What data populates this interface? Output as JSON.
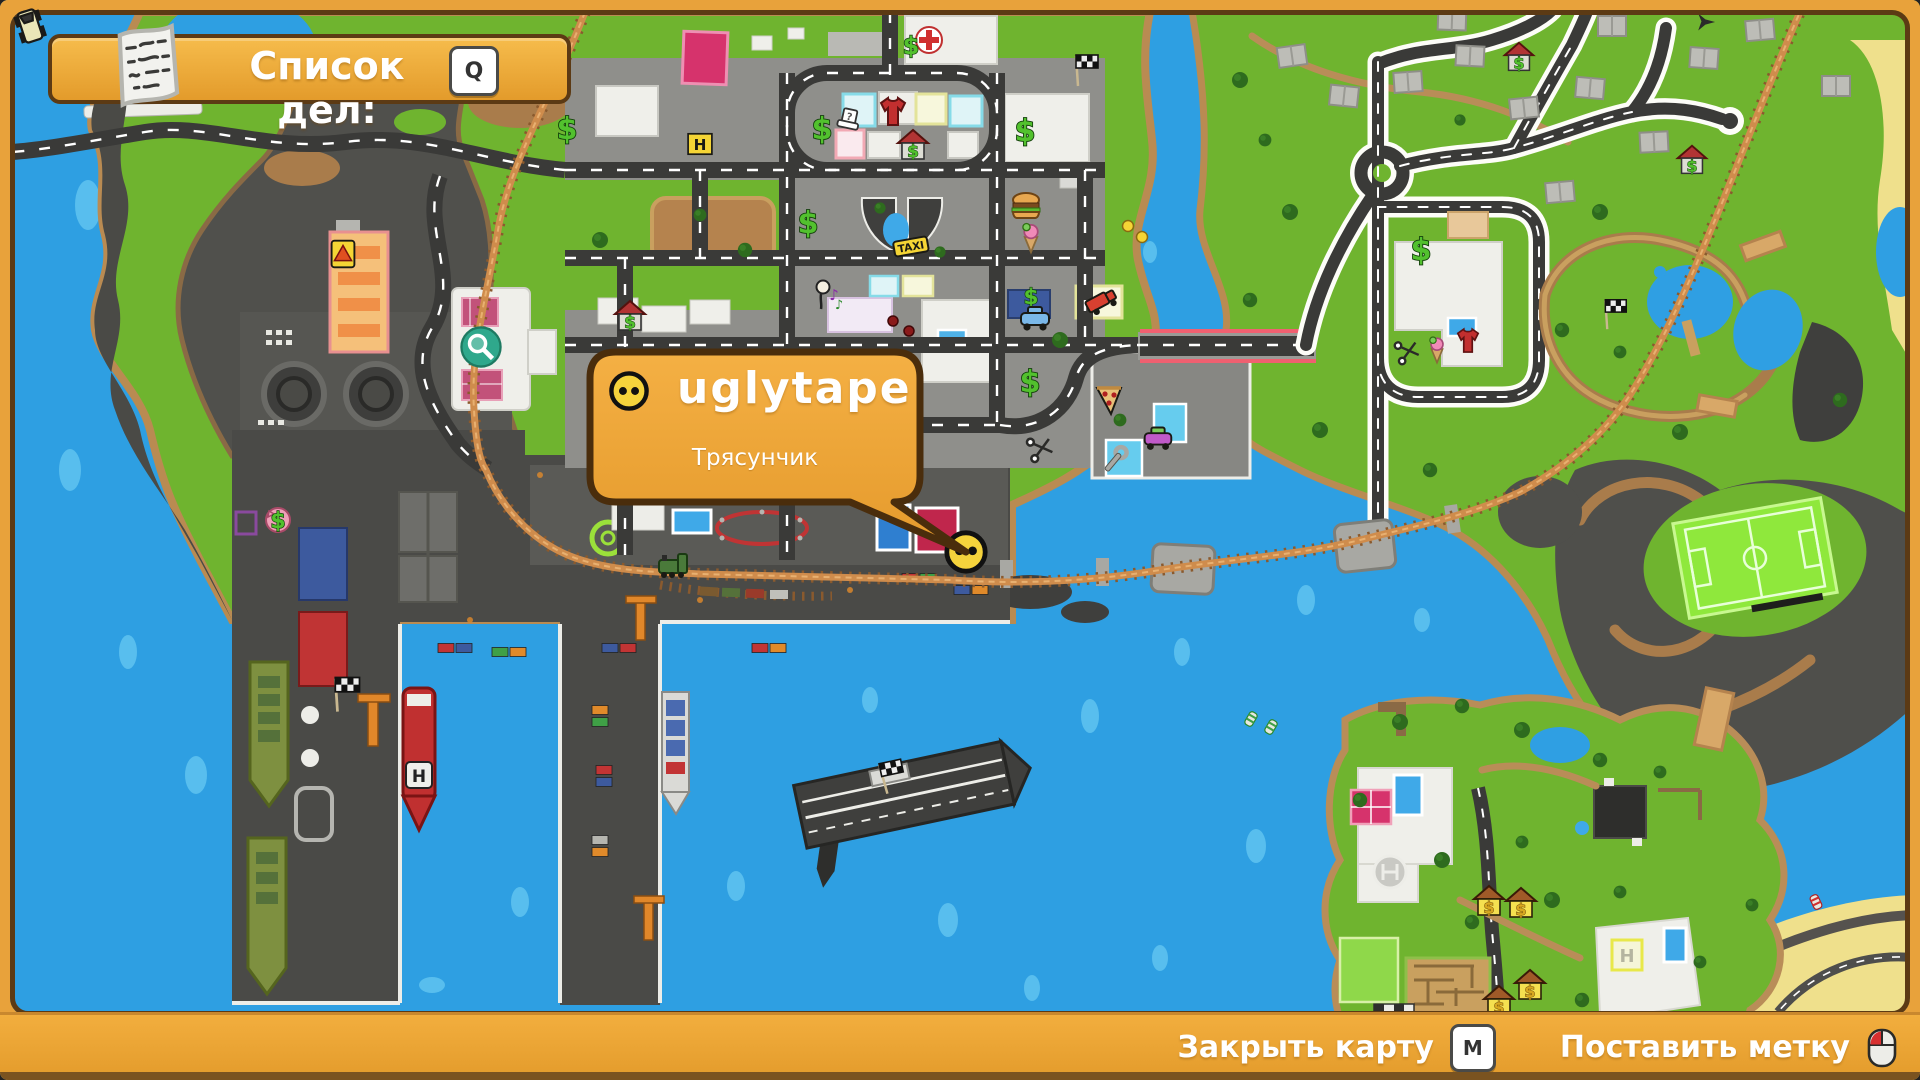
{
  "colors": {
    "frame": "#E8A23B",
    "frame-dark": "#5C3A14",
    "water": "#2E9FE2",
    "water-light": "#58BEEE",
    "land": "#6FB42F",
    "rock": "#50504C",
    "road": "#3A3A38",
    "rail": "#CF8C4C",
    "bubble": "#F0A83C"
  },
  "todo_banner": {
    "label": "Список дел:",
    "key": "Q",
    "icon": "note-paper-icon"
  },
  "player_tooltip": {
    "name": "uglytape",
    "subtitle": "Трясунчик",
    "icon": "smiley-face-icon"
  },
  "bottom_bar": {
    "close_map_label": "Закрыть карту",
    "close_map_key": "M",
    "place_marker_label": "Поставить метку",
    "place_marker_icon": "mouse-icon"
  },
  "map": {
    "labels": {
      "taxi": "TAXI",
      "helipad_letter": "H"
    },
    "markers": [
      {
        "type": "dollar",
        "x": 567,
        "y": 128
      },
      {
        "type": "dollar",
        "x": 822,
        "y": 128
      },
      {
        "type": "hat-question",
        "x": 849,
        "y": 121,
        "s": 0.9
      },
      {
        "type": "shirt",
        "x": 893,
        "y": 112
      },
      {
        "type": "house-dollar",
        "x": 913,
        "y": 146
      },
      {
        "type": "dollar",
        "x": 1025,
        "y": 130
      },
      {
        "type": "flag",
        "x": 1083,
        "y": 70
      },
      {
        "type": "helipad",
        "x": 700,
        "y": 144,
        "s": 0.85,
        "label": "H"
      },
      {
        "type": "hospital",
        "x": 929,
        "y": 40
      },
      {
        "type": "dollar",
        "x": 911,
        "y": 45,
        "s": 0.8
      },
      {
        "type": "dollar",
        "x": 808,
        "y": 222
      },
      {
        "type": "burger",
        "x": 1026,
        "y": 207
      },
      {
        "type": "icecream",
        "x": 1031,
        "y": 237,
        "s": 0.9
      },
      {
        "type": "taxi",
        "x": 911,
        "y": 247,
        "label": "TAXI"
      },
      {
        "type": "music-person",
        "x": 828,
        "y": 296
      },
      {
        "type": "pin",
        "x": 893,
        "y": 321
      },
      {
        "type": "pin",
        "x": 909,
        "y": 331
      },
      {
        "type": "house-dollar",
        "x": 630,
        "y": 317
      },
      {
        "type": "dollar",
        "x": 1031,
        "y": 296,
        "s": 0.72
      },
      {
        "type": "car-blue",
        "x": 1035,
        "y": 317
      },
      {
        "type": "truck-red",
        "x": 1100,
        "y": 301
      },
      {
        "type": "dollar",
        "x": 1030,
        "y": 381
      },
      {
        "type": "pizza",
        "x": 1109,
        "y": 400
      },
      {
        "type": "car-purple",
        "x": 1158,
        "y": 437,
        "s": 0.95
      },
      {
        "type": "wrench",
        "x": 1114,
        "y": 461
      },
      {
        "type": "scissors",
        "x": 1041,
        "y": 449,
        "s": 0.85
      },
      {
        "type": "wrench",
        "x": 869,
        "y": 458,
        "s": 0.75
      },
      {
        "type": "warning",
        "x": 343,
        "y": 254,
        "s": 0.95
      },
      {
        "type": "magnifier",
        "x": 481,
        "y": 347,
        "s": 1.15
      },
      {
        "type": "pig-dollar",
        "x": 278,
        "y": 518
      },
      {
        "type": "flag",
        "x": 343,
        "y": 694,
        "s": 1.1
      },
      {
        "type": "train",
        "x": 672,
        "y": 565
      },
      {
        "type": "flag",
        "x": 889,
        "y": 777,
        "r": -12
      },
      {
        "type": "player-smiley",
        "x": 966,
        "y": 552,
        "s": 1.2,
        "interactable": true
      },
      {
        "type": "house-dollar",
        "x": 1519,
        "y": 58,
        "s": 0.95
      },
      {
        "type": "house-dollar",
        "x": 1692,
        "y": 161,
        "s": 0.95
      },
      {
        "type": "dollar",
        "x": 1421,
        "y": 249
      },
      {
        "type": "scissors",
        "x": 1408,
        "y": 352,
        "s": 0.8
      },
      {
        "type": "icecream",
        "x": 1437,
        "y": 349,
        "s": 0.8
      },
      {
        "type": "shirt",
        "x": 1468,
        "y": 341,
        "s": 0.85
      },
      {
        "type": "flag",
        "x": 1612,
        "y": 314,
        "s": 0.95
      },
      {
        "type": "plane",
        "x": 1706,
        "y": 22,
        "s": 0.65
      },
      {
        "type": "gold-house",
        "x": 1489,
        "y": 902
      },
      {
        "type": "gold-house",
        "x": 1521,
        "y": 904
      },
      {
        "type": "gold-house",
        "x": 1530,
        "y": 986
      },
      {
        "type": "gold-house",
        "x": 1499,
        "y": 1002
      },
      {
        "type": "buoy-yellow",
        "x": 1128,
        "y": 226,
        "s": 0.5
      },
      {
        "type": "buoy-yellow",
        "x": 1142,
        "y": 237,
        "s": 0.5
      },
      {
        "type": "buoy-green",
        "x": 1251,
        "y": 719,
        "s": 0.6
      },
      {
        "type": "buoy-green",
        "x": 1271,
        "y": 727,
        "s": 0.6
      },
      {
        "type": "buoy-red",
        "x": 1816,
        "y": 902,
        "s": 0.6
      }
    ]
  }
}
